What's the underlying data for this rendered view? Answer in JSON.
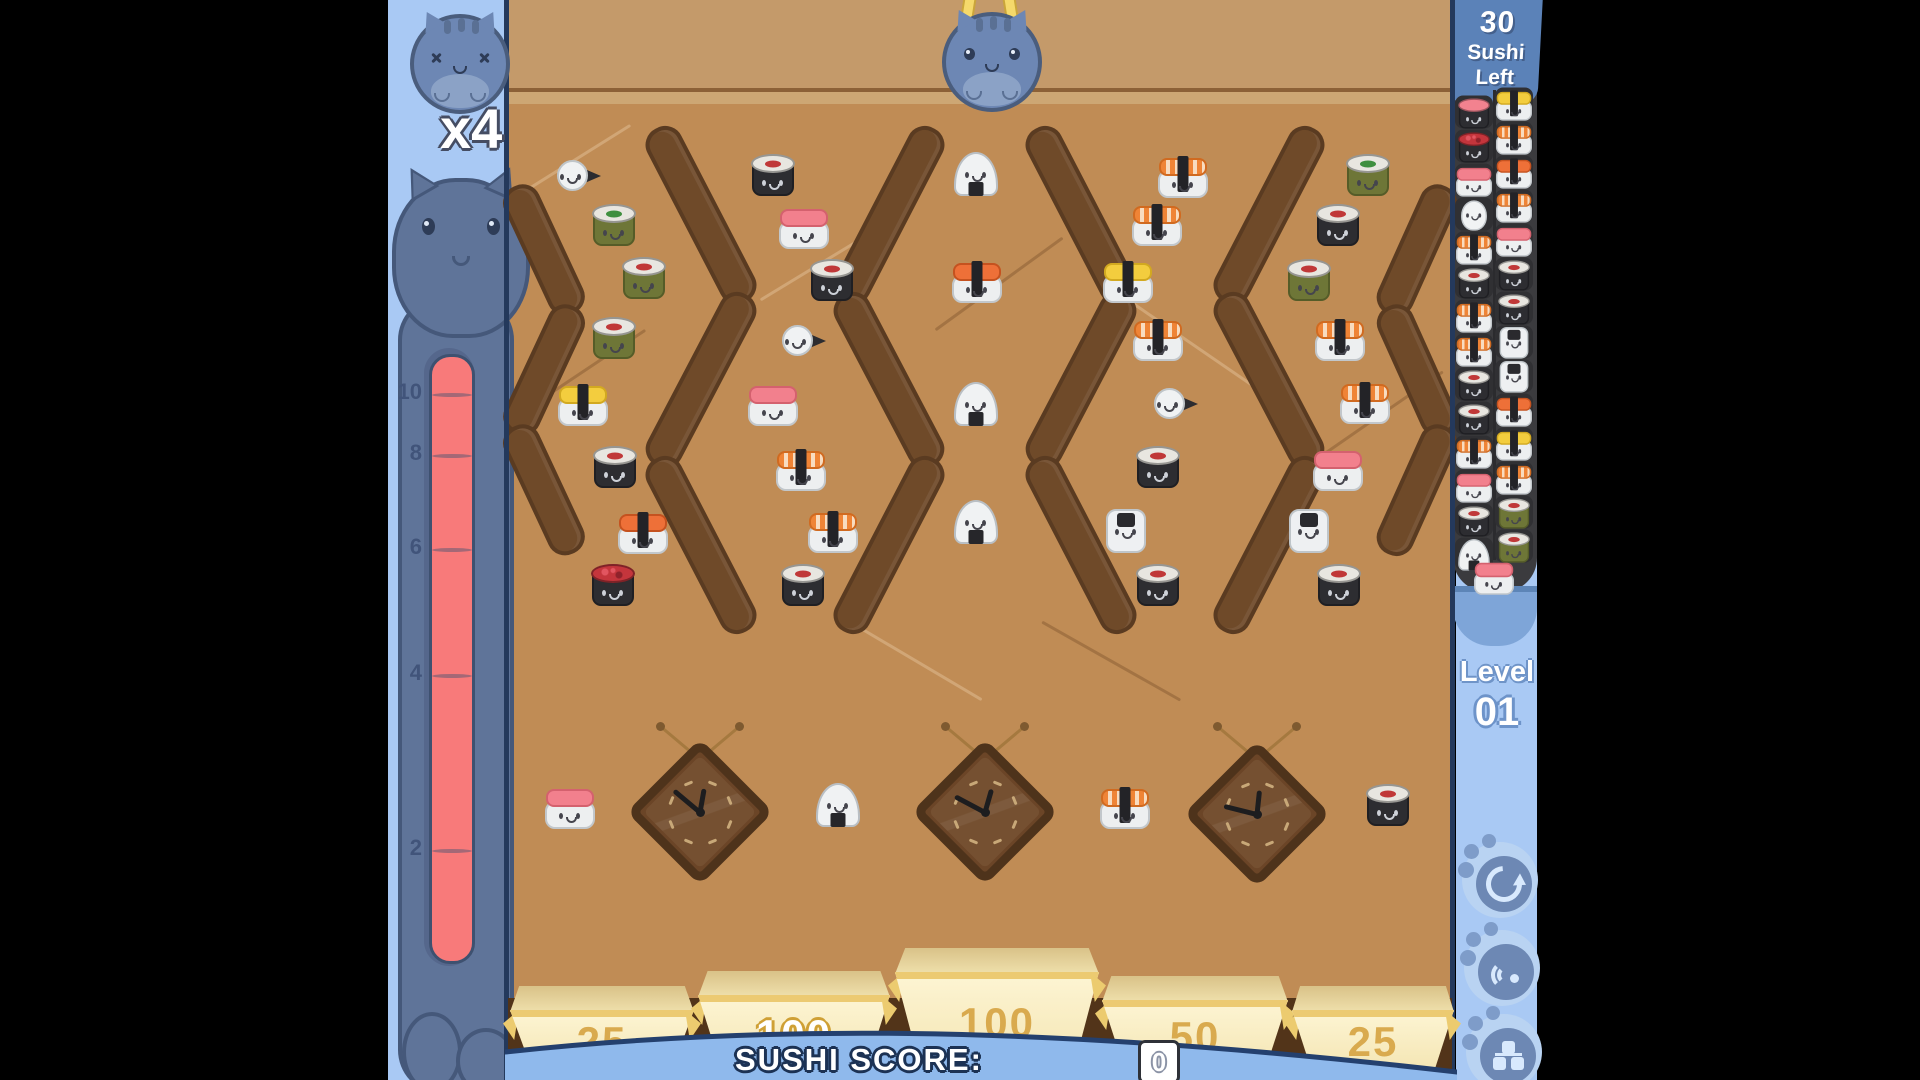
{
  "hud": {
    "multiplier": "x4",
    "sushi_left": {
      "value": "30",
      "line1": "Sushi",
      "line2": "Left"
    },
    "level": {
      "label": "Level",
      "value": "01"
    },
    "score": {
      "label": "SUSHI SCORE:",
      "value": "0"
    },
    "meter": {
      "ticks": [
        "10",
        "8",
        "6",
        "4",
        "2"
      ]
    }
  },
  "buckets": [
    {
      "value": "25",
      "x": 510,
      "top": 986,
      "w": 184,
      "lit": false
    },
    {
      "value": "100",
      "x": 698,
      "top": 971,
      "w": 192,
      "lit": true
    },
    {
      "value": "100",
      "x": 895,
      "top": 948,
      "w": 204,
      "lit": false
    },
    {
      "value": "50",
      "x": 1102,
      "top": 976,
      "w": 186,
      "lit": false
    },
    {
      "value": "25",
      "x": 1292,
      "top": 986,
      "w": 162,
      "lit": false
    }
  ],
  "board": {
    "sushi": [
      {
        "type": "temaki",
        "x": 578,
        "y": 177
      },
      {
        "type": "maki-dark",
        "x": 773,
        "y": 175
      },
      {
        "type": "onigiri",
        "x": 976,
        "y": 175
      },
      {
        "type": "nigiri-ebi",
        "x": 1183,
        "y": 177
      },
      {
        "type": "maki-green-g",
        "x": 1368,
        "y": 175
      },
      {
        "type": "maki-green-g",
        "x": 614,
        "y": 225
      },
      {
        "type": "nigiri-salmon",
        "x": 804,
        "y": 228
      },
      {
        "type": "nigiri-ebi",
        "x": 1157,
        "y": 225
      },
      {
        "type": "maki-dark",
        "x": 1338,
        "y": 225
      },
      {
        "type": "maki-green-r",
        "x": 644,
        "y": 278
      },
      {
        "type": "maki-dark",
        "x": 832,
        "y": 280
      },
      {
        "type": "nigiri-orange",
        "x": 977,
        "y": 282
      },
      {
        "type": "nigiri-tamago",
        "x": 1128,
        "y": 282
      },
      {
        "type": "maki-green-r",
        "x": 1309,
        "y": 280
      },
      {
        "type": "maki-green-r",
        "x": 614,
        "y": 338
      },
      {
        "type": "temaki",
        "x": 803,
        "y": 342
      },
      {
        "type": "nigiri-ebi",
        "x": 1158,
        "y": 340
      },
      {
        "type": "nigiri-ebi",
        "x": 1340,
        "y": 340
      },
      {
        "type": "nigiri-tamago",
        "x": 583,
        "y": 405
      },
      {
        "type": "nigiri-salmon",
        "x": 773,
        "y": 405
      },
      {
        "type": "onigiri",
        "x": 976,
        "y": 405
      },
      {
        "type": "temaki",
        "x": 1175,
        "y": 405
      },
      {
        "type": "nigiri-ebi",
        "x": 1365,
        "y": 403
      },
      {
        "type": "maki-dark",
        "x": 615,
        "y": 467
      },
      {
        "type": "nigiri-ebi",
        "x": 801,
        "y": 470
      },
      {
        "type": "maki-dark",
        "x": 1158,
        "y": 467
      },
      {
        "type": "nigiri-salmon",
        "x": 1338,
        "y": 470
      },
      {
        "type": "nigiri-orange",
        "x": 643,
        "y": 533
      },
      {
        "type": "nigiri-ebi",
        "x": 833,
        "y": 532
      },
      {
        "type": "onigiri",
        "x": 976,
        "y": 523
      },
      {
        "type": "squid",
        "x": 1126,
        "y": 532
      },
      {
        "type": "squid",
        "x": 1309,
        "y": 532
      },
      {
        "type": "maki-roe",
        "x": 613,
        "y": 585
      },
      {
        "type": "maki-dark",
        "x": 803,
        "y": 585
      },
      {
        "type": "maki-dark",
        "x": 1158,
        "y": 585
      },
      {
        "type": "maki-dark",
        "x": 1339,
        "y": 585
      },
      {
        "type": "nigiri-salmon",
        "x": 570,
        "y": 808
      },
      {
        "type": "onigiri",
        "x": 838,
        "y": 806
      },
      {
        "type": "nigiri-ebi",
        "x": 1125,
        "y": 808
      },
      {
        "type": "maki-dark",
        "x": 1388,
        "y": 805
      }
    ],
    "clocks": [
      {
        "x": 700,
        "y": 812,
        "minute": -50,
        "hour": 10
      },
      {
        "x": 985,
        "y": 812,
        "minute": -62,
        "hour": 16
      },
      {
        "x": 1257,
        "y": 814,
        "minute": -76,
        "hour": 6
      }
    ],
    "pegs": [
      {
        "x1": 658,
        "y1": 132,
        "x2": 744,
        "y2": 298
      },
      {
        "x1": 744,
        "y1": 298,
        "x2": 658,
        "y2": 462
      },
      {
        "x1": 658,
        "y1": 462,
        "x2": 744,
        "y2": 628
      },
      {
        "x1": 932,
        "y1": 132,
        "x2": 846,
        "y2": 298
      },
      {
        "x1": 846,
        "y1": 298,
        "x2": 932,
        "y2": 462
      },
      {
        "x1": 932,
        "y1": 462,
        "x2": 846,
        "y2": 628
      },
      {
        "x1": 1038,
        "y1": 132,
        "x2": 1124,
        "y2": 298
      },
      {
        "x1": 1124,
        "y1": 298,
        "x2": 1038,
        "y2": 462
      },
      {
        "x1": 1038,
        "y1": 462,
        "x2": 1124,
        "y2": 628
      },
      {
        "x1": 1312,
        "y1": 132,
        "x2": 1226,
        "y2": 298
      },
      {
        "x1": 1226,
        "y1": 298,
        "x2": 1312,
        "y2": 462
      },
      {
        "x1": 1312,
        "y1": 462,
        "x2": 1226,
        "y2": 628
      },
      {
        "x1": 516,
        "y1": 190,
        "x2": 572,
        "y2": 310
      },
      {
        "x1": 572,
        "y1": 310,
        "x2": 516,
        "y2": 430
      },
      {
        "x1": 516,
        "y1": 430,
        "x2": 572,
        "y2": 550
      },
      {
        "x1": 1444,
        "y1": 190,
        "x2": 1390,
        "y2": 310
      },
      {
        "x1": 1390,
        "y1": 310,
        "x2": 1444,
        "y2": 430
      },
      {
        "x1": 1444,
        "y1": 430,
        "x2": 1390,
        "y2": 550
      }
    ],
    "facets": [
      {
        "x1": 510,
        "y1": 200,
        "x2": 630,
        "y2": 125
      },
      {
        "x1": 510,
        "y1": 420,
        "x2": 645,
        "y2": 330
      },
      {
        "x1": 760,
        "y1": 300,
        "x2": 905,
        "y2": 212
      },
      {
        "x1": 935,
        "y1": 330,
        "x2": 1062,
        "y2": 238
      },
      {
        "x1": 1128,
        "y1": 300,
        "x2": 1262,
        "y2": 392
      },
      {
        "x1": 1315,
        "y1": 460,
        "x2": 1442,
        "y2": 372
      },
      {
        "x1": 850,
        "y1": 622,
        "x2": 982,
        "y2": 700
      },
      {
        "x1": 1042,
        "y1": 622,
        "x2": 1180,
        "y2": 700
      }
    ]
  },
  "queue": {
    "left": [
      "maki-salmon",
      "maki-roe",
      "nigiri-salmon",
      "egg",
      "nigiri-ebi",
      "maki-dark",
      "nigiri-ebi",
      "nigiri-ebi",
      "maki-dark",
      "maki-dark",
      "nigiri-ebi",
      "nigiri-salmon",
      "maki-dark",
      "onigiri"
    ],
    "right": [
      "nigiri-tamago",
      "nigiri-ebi",
      "nigiri-orange",
      "nigiri-ebi",
      "nigiri-salmon",
      "maki-dark",
      "maki-dark",
      "squid",
      "squid",
      "nigiri-orange",
      "nigiri-tamago",
      "nigiri-ebi",
      "maki-green-r",
      "maki-green-r"
    ],
    "pouch": "nigiri-salmon"
  },
  "buttons": [
    {
      "name": "restart-button",
      "icon": "restart-icon"
    },
    {
      "name": "sound-button",
      "icon": "sound-icon"
    },
    {
      "name": "blocks-button",
      "icon": "blocks-icon"
    }
  ],
  "colors": {
    "panel_blue": "#a9c9f4",
    "tab_blue": "#5b82b8",
    "board_tan": "#c08c55",
    "peg_brown": "#6f4a29",
    "bucket_cream": "#fdf3cf",
    "banner_blue": "#8fb9ec",
    "meter_red": "#f87a7a",
    "queue_gray": "#3b3b3e",
    "navy": "#24406e",
    "gold": "#d9aa4e"
  }
}
